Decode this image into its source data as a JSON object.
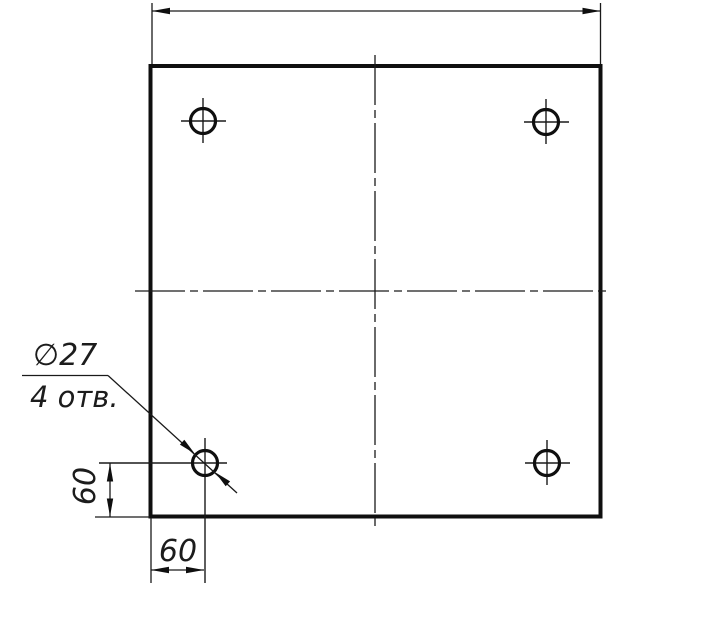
{
  "callout": {
    "diameter": "∅27",
    "count": "4 отв."
  },
  "dims": {
    "left_offset": "60",
    "bottom_offset": "60"
  },
  "colors": {
    "line": "#0f0f0f",
    "background": "#ffffff"
  }
}
